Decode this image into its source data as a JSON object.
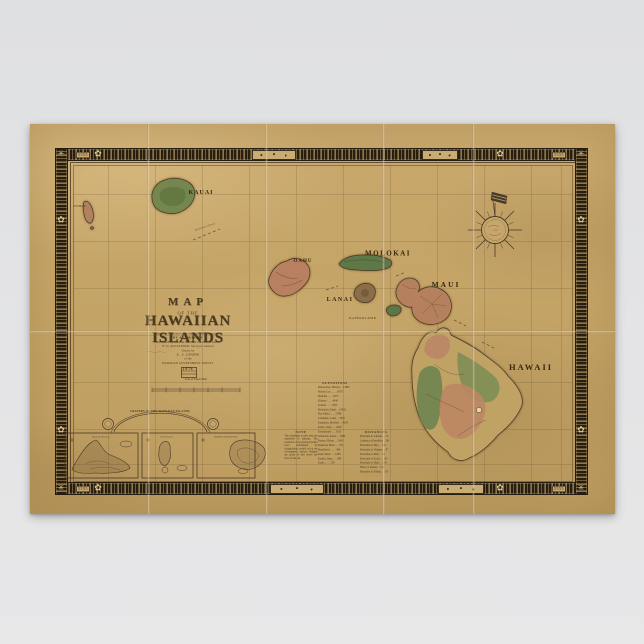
{
  "scene": {
    "background_color": "#e3e4e6",
    "paper_color": "#c6a569"
  },
  "poster": {
    "border_corner_mark": "5555",
    "title": {
      "word": "MAP",
      "connector": "OF THE",
      "main": "HAWAIIAN ISLANDS"
    },
    "imprint": {
      "line1": "Compiled from the latest explorations and surveys",
      "line2": "BY AUTHORITY",
      "line3": "Published by order of the Hawaiian Government",
      "line4": "W. D. ALEXANDER, Surveyor General",
      "line5": "Drawn by",
      "line6": "C. J. LYONS",
      "line7": "of the",
      "line8": "HAWAIIAN GOVERNMENT SURVEY",
      "year": "1876",
      "scale_caption": "Scale of Statute Miles"
    },
    "islands": {
      "niihau": "NIIHAU",
      "kauai": "KAUAI",
      "oahu": "OAHU",
      "molokai": "MOLOKAI",
      "lanai": "LANAI",
      "kahoolawe": "KAHOOLAWE",
      "maui": "MAUI",
      "hawaii": "HAWAII"
    },
    "channel_label": "Kaieiewaho Channel",
    "insets": {
      "arch_title": "CRATERS OF THE HAWAIIAN ISLANDS",
      "panels": [
        {
          "caption": "HALEAKALA"
        },
        {
          "caption": "KILAUEA"
        },
        {
          "caption": "MOKUAWEOWEO"
        }
      ]
    },
    "note": {
      "heading": "NOTE",
      "body": "The soundings on this map are expressed in fathoms. The positions of the principal points were determined by triangulation carried on by the Government Survey. Heights are given in feet above the level of the sea."
    },
    "tables": {
      "elevations": {
        "heading": "ELEVATIONS",
        "rows": [
          "Mauna Kea, Hawaii . . 13805",
          "Mauna Loa . . . . 13675",
          "Hualalai . . . . 8275",
          "Kilauea . . . . 4040",
          "Kohala . . . . 5505",
          "Haleakala, Maui . . 10032",
          "Puu Kukui . . . . 5788",
          "Lanaihale, Lanai . . 3370",
          "Kamakou, Molokai . . 4958",
          "Kaala, Oahu . . . 4030",
          "Konahuanui . . . 3105",
          "Waialeale, Kauai . . 5080",
          "Paniau, Niihau . . 1304",
          "Diamond Head . . . 761",
          "Punchbowl . . . . 498",
          "Koko Head . . . 1208",
          "Kauiki, Hana . . . 386",
          "Kaula . . . . 550"
        ]
      },
      "distances": {
        "heading": "DISTANCES",
        "rows": [
          "Honolulu to Lahaina . . 72",
          "Lahaina to Kawaihae . . 68",
          "Honolulu to Hilo . . 192",
          "Honolulu to Waimea . . 97",
          "Kawaihae to Hilo . . 85",
          "Honolulu to Koloa . . 102",
          "Honolulu to Hana . . 128",
          "Hilo to Lahaina . . 120",
          "Honolulu to Niihau . . 135"
        ]
      }
    }
  }
}
